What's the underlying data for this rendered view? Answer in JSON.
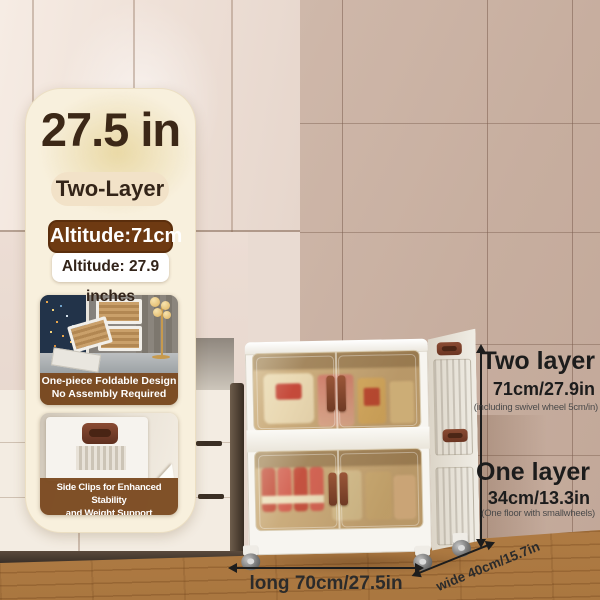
{
  "card": {
    "headline": "27.5 in",
    "tag": "Two-Layer",
    "altitude_metric": "Altitude:71cm",
    "altitude_imperial": "Altitude: 27.9 inches",
    "feature_foldable": {
      "line1": "One-piece Foldable Design",
      "line2": "No Assembly Required"
    },
    "feature_clips": {
      "line1": "Side Clips for Enhanced Stability",
      "line2": "and Weight Support"
    }
  },
  "annotations": {
    "two_layer": {
      "label": "Two layer",
      "value": "71cm/27.9in",
      "note": "(including swivel wheel 5cm/in)"
    },
    "one_layer": {
      "label": "One layer",
      "value": "34cm/13.3in",
      "note": "(One floor with smallwheels)"
    },
    "length_label": "long 70cm/27.5in",
    "width_label": "wide 40cm/15.7in"
  },
  "colors": {
    "accent_brown": "#6e3a12",
    "caption_brown": "#7b4a20",
    "handle_brown": "#81432c",
    "card_bg": "#f8f0dd",
    "tile_wall": "#c9b1a3",
    "floor_wood": "#bf8c51",
    "annotation_text": "#1d1d1d"
  }
}
